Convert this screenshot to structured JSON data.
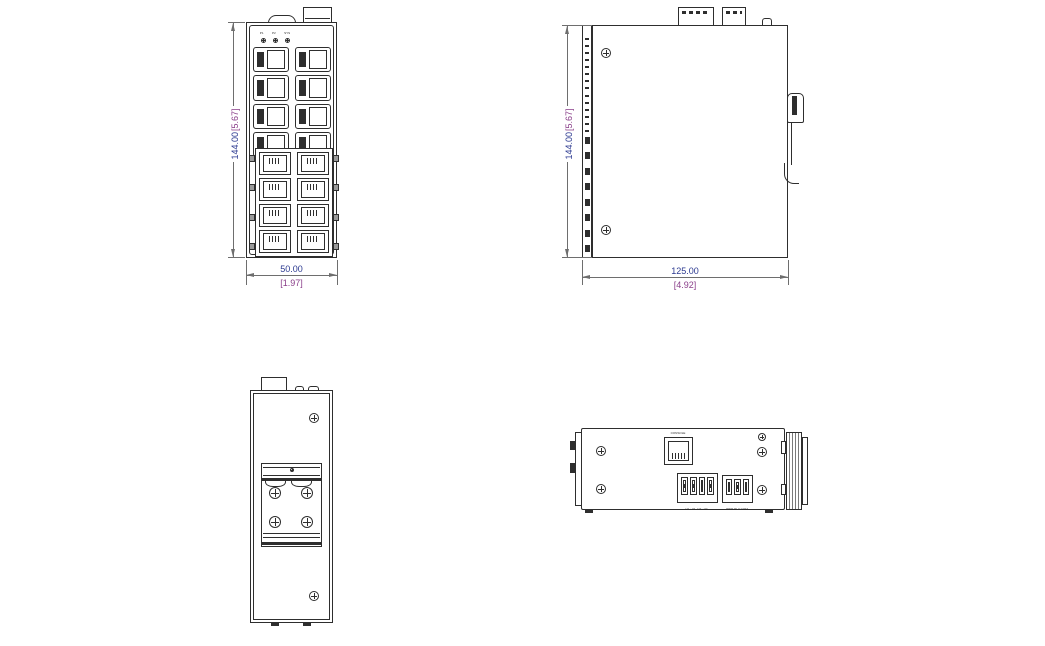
{
  "drawing_title": "industrial-ethernet-switch-dimensional-drawing",
  "colors": {
    "line": "#2e2e2e",
    "dim_line": "#6e6e6e",
    "mm": "#2b3990",
    "inch": "#8a3f8a"
  },
  "front_view": {
    "height_mm": "144.00",
    "height_in": "[5.67]",
    "width_mm": "50.00",
    "width_in": "[1.97]",
    "led_labels": [
      "P1",
      "P2",
      "SYS"
    ],
    "sfp_count": 8,
    "rj45_count": 8,
    "tab_count": 4
  },
  "side_view": {
    "height_mm": "144.00",
    "height_in": "[5.67]",
    "width_mm": "125.00",
    "width_in": "[4.92]",
    "vent_small_count": 14,
    "vent_large_count": 8
  },
  "rear_view": {
    "bracket_screw_count": 4
  },
  "top_view": {
    "console_label": "CONSOLE",
    "power_block1_pins": 4,
    "power_block2_pins": 3,
    "power_block1_label": "V1+ V1- V2+ V2-",
    "power_block2_label": "PWR RLY COM"
  }
}
